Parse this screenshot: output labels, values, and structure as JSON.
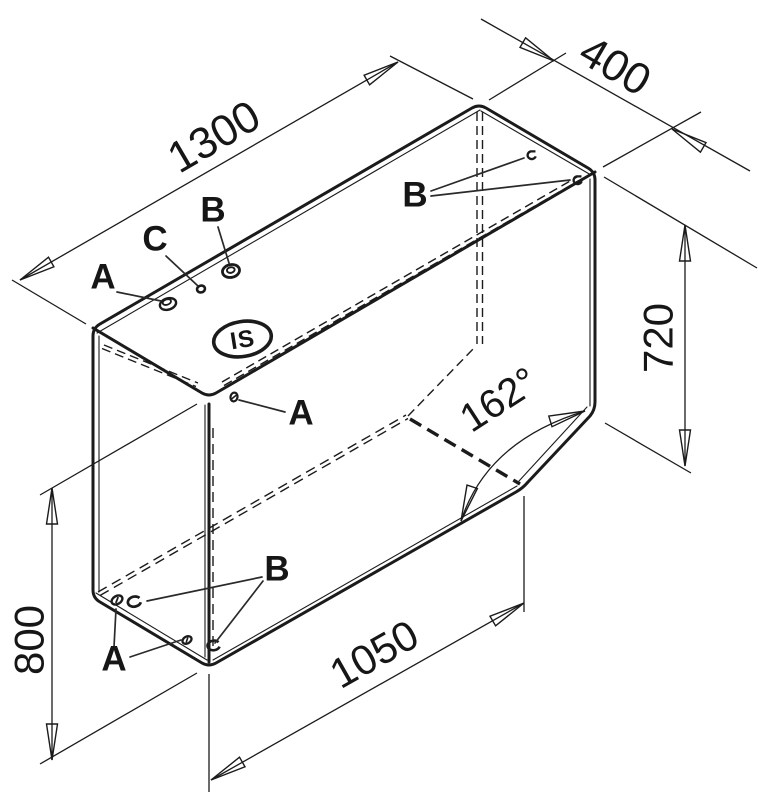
{
  "drawing": {
    "logo": "IS",
    "dimensions": {
      "top_length": "1300",
      "depth": "400",
      "right_height": "720",
      "front_height": "800",
      "bottom_length": "1050",
      "chamfer_angle": "162°"
    },
    "labels": {
      "a": "A",
      "b": "B",
      "c": "C"
    },
    "colors": {
      "ink": "#1b1b1b",
      "paper": "#ffffff"
    }
  }
}
